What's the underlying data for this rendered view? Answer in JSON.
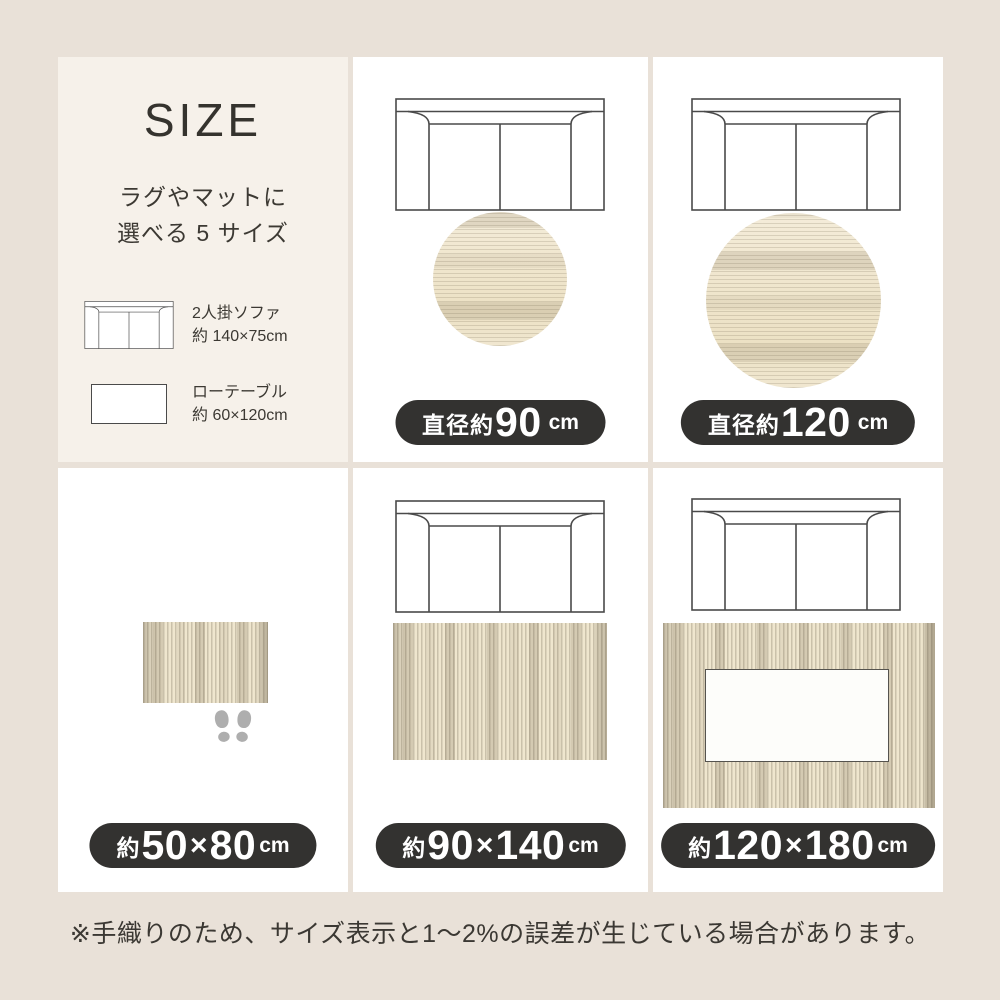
{
  "colors": {
    "page_background": "#e9e1d8",
    "panel_background": "#ffffff",
    "intro_panel_background": "#f6f1ea",
    "pill_background": "#333230",
    "pill_text": "#ffffff",
    "text": "#3c3933",
    "rug_base": "#efe6ce",
    "sofa_outline": "#4a4a4a",
    "footprints_gray": "#aeaeae"
  },
  "intro": {
    "title": "SIZE",
    "subtitle": [
      "ラグやマットに",
      "選べる 5 サイズ"
    ],
    "legend": [
      {
        "icon": "sofa-icon",
        "name": "2人掛ソファ",
        "size": "約 140×75cm"
      },
      {
        "icon": "low-table-icon",
        "name": "ローテーブル",
        "size": "約 60×120cm"
      }
    ]
  },
  "panels": [
    {
      "id": "round-90",
      "rug_shape": "round",
      "label": {
        "prefix": "直径約",
        "a": "90",
        "x": "",
        "b": "",
        "unit": "cm"
      }
    },
    {
      "id": "round-120",
      "rug_shape": "round",
      "label": {
        "prefix": "直径約",
        "a": "120",
        "x": "",
        "b": "",
        "unit": "cm"
      }
    },
    {
      "id": "mat-50x80",
      "rug_shape": "rectangle",
      "label": {
        "prefix": "約",
        "a": "50",
        "x": "×",
        "b": "80",
        "unit": "cm"
      }
    },
    {
      "id": "rug-90x140",
      "rug_shape": "rectangle",
      "label": {
        "prefix": "約",
        "a": "90",
        "x": "×",
        "b": "140",
        "unit": "cm"
      }
    },
    {
      "id": "rug-120x180",
      "rug_shape": "rectangle",
      "label": {
        "prefix": "約",
        "a": "120",
        "x": "×",
        "b": "180",
        "unit": "cm"
      }
    }
  ],
  "footnote": "※手織りのため、サイズ表示と1～2%の誤差が生じている場合があります。"
}
